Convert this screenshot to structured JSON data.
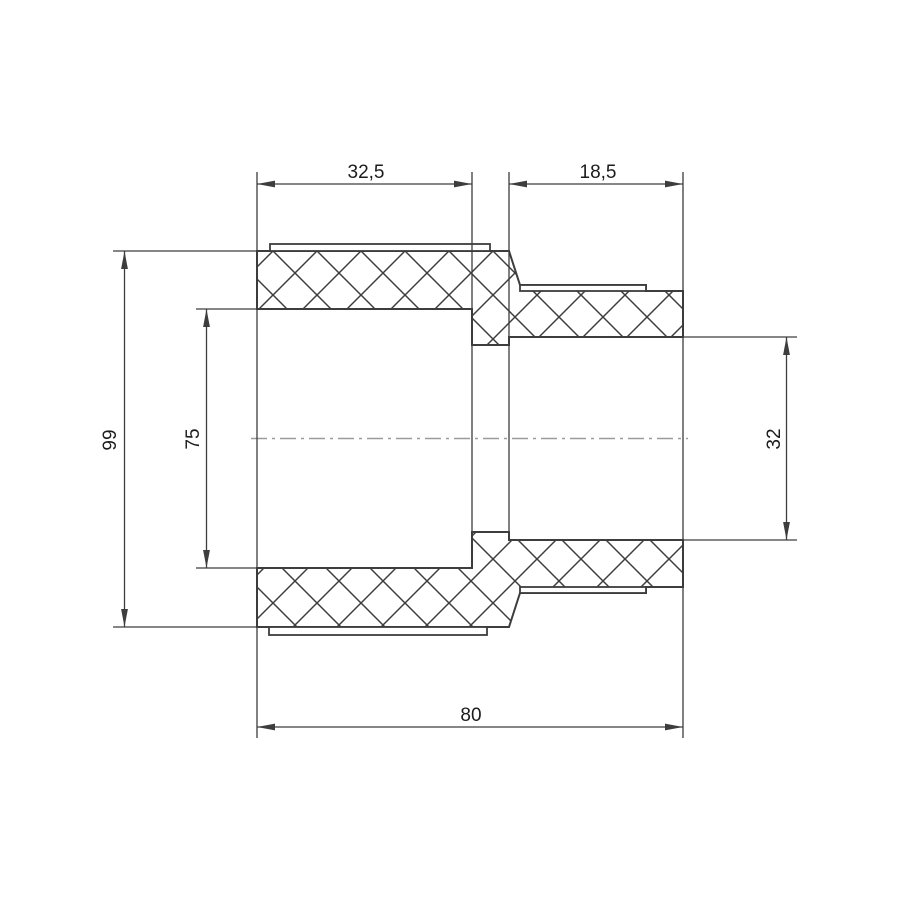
{
  "drawing": {
    "kind": "sectional technical drawing of a pipe fitting"
  },
  "colors": {
    "line": "#3d3d3d",
    "centerline": "#9b9b9b",
    "text": "#1c1c1c",
    "background": "#ffffff"
  },
  "dimensions": {
    "left_socket_depth": {
      "label": "32,5",
      "orientation": "horizontal"
    },
    "right_socket_depth": {
      "label": "18,5",
      "orientation": "horizontal"
    },
    "body_outer_diameter": {
      "label": "99",
      "orientation": "vertical"
    },
    "left_inner_diameter": {
      "label": "75",
      "orientation": "vertical"
    },
    "right_inner_diameter": {
      "label": "32",
      "orientation": "vertical"
    },
    "overall_length": {
      "label": "80",
      "orientation": "horizontal"
    }
  }
}
